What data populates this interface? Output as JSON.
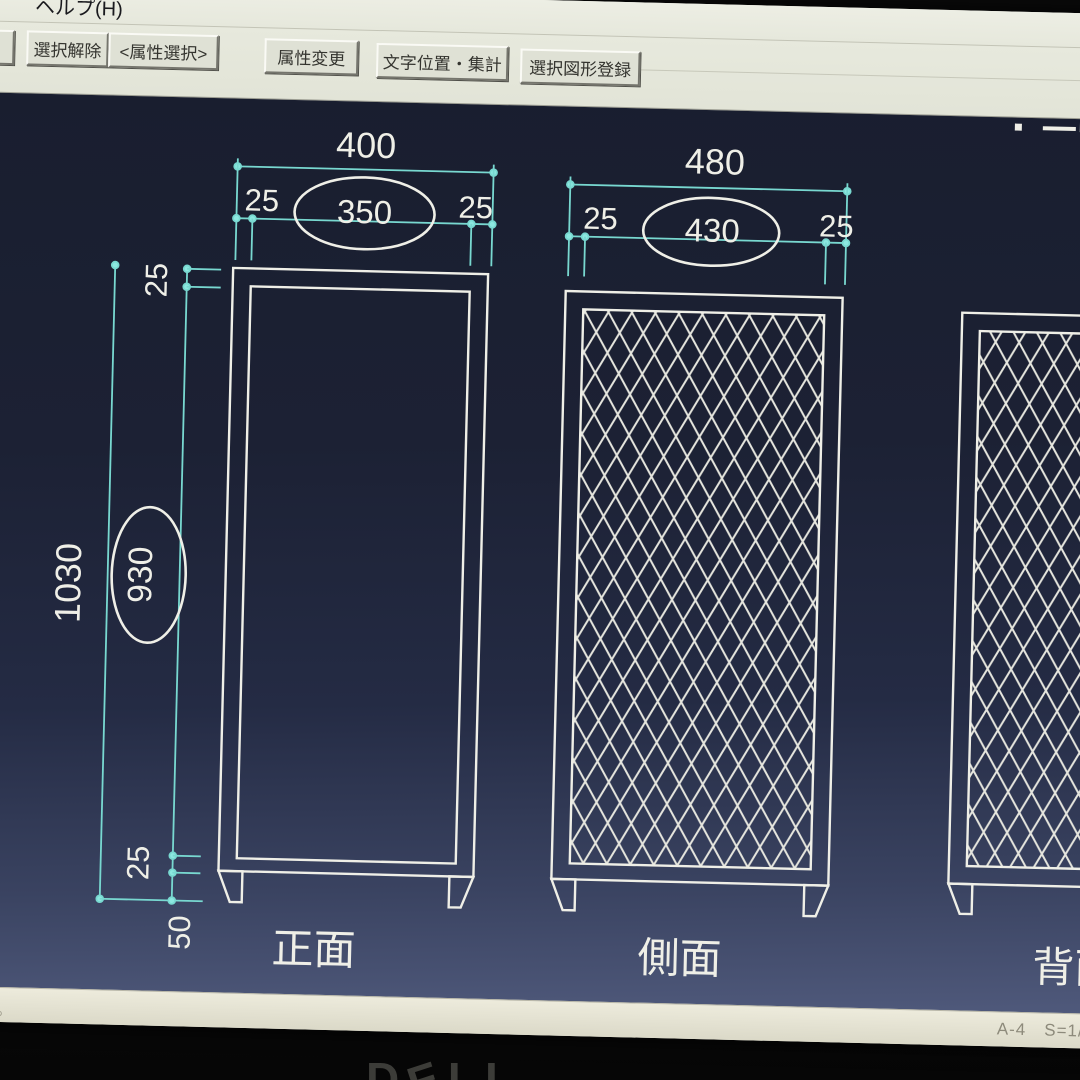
{
  "menu": {
    "left_partial": "A)]",
    "help": "ヘルプ(H)"
  },
  "toolbar": {
    "buttons": [
      {
        "label": "択"
      },
      {
        "label": "選択解除"
      },
      {
        "label": "<属性選択>"
      },
      {
        "label": "属性変更"
      },
      {
        "label": "文字位置・集計"
      },
      {
        "label": "選択図形登録"
      }
    ]
  },
  "drawing": {
    "views": [
      {
        "name": "front",
        "label": "正面",
        "width_total": "400",
        "width_parts": [
          "25",
          "350",
          "25"
        ]
      },
      {
        "name": "side",
        "label": "側面",
        "width_total": "480",
        "width_parts": [
          "25",
          "430",
          "25"
        ]
      },
      {
        "name": "back",
        "label": "背面"
      }
    ],
    "height": {
      "total": "1030",
      "top": "25",
      "middle": "930",
      "bottom": "25",
      "foot": "50"
    }
  },
  "statusbar": {
    "message": "ださい。",
    "sheet": "A-4",
    "scale": "S=1/"
  },
  "monitor": {
    "brand_letters": [
      "D",
      "E",
      "L",
      "L"
    ]
  },
  "colors": {
    "dimension_cyan": "#78d8d0",
    "line_white": "#efefe7",
    "canvas_navy_top": "#191e2f",
    "canvas_navy_bottom": "#4f597b",
    "ui_background": "#e7e9dd"
  }
}
